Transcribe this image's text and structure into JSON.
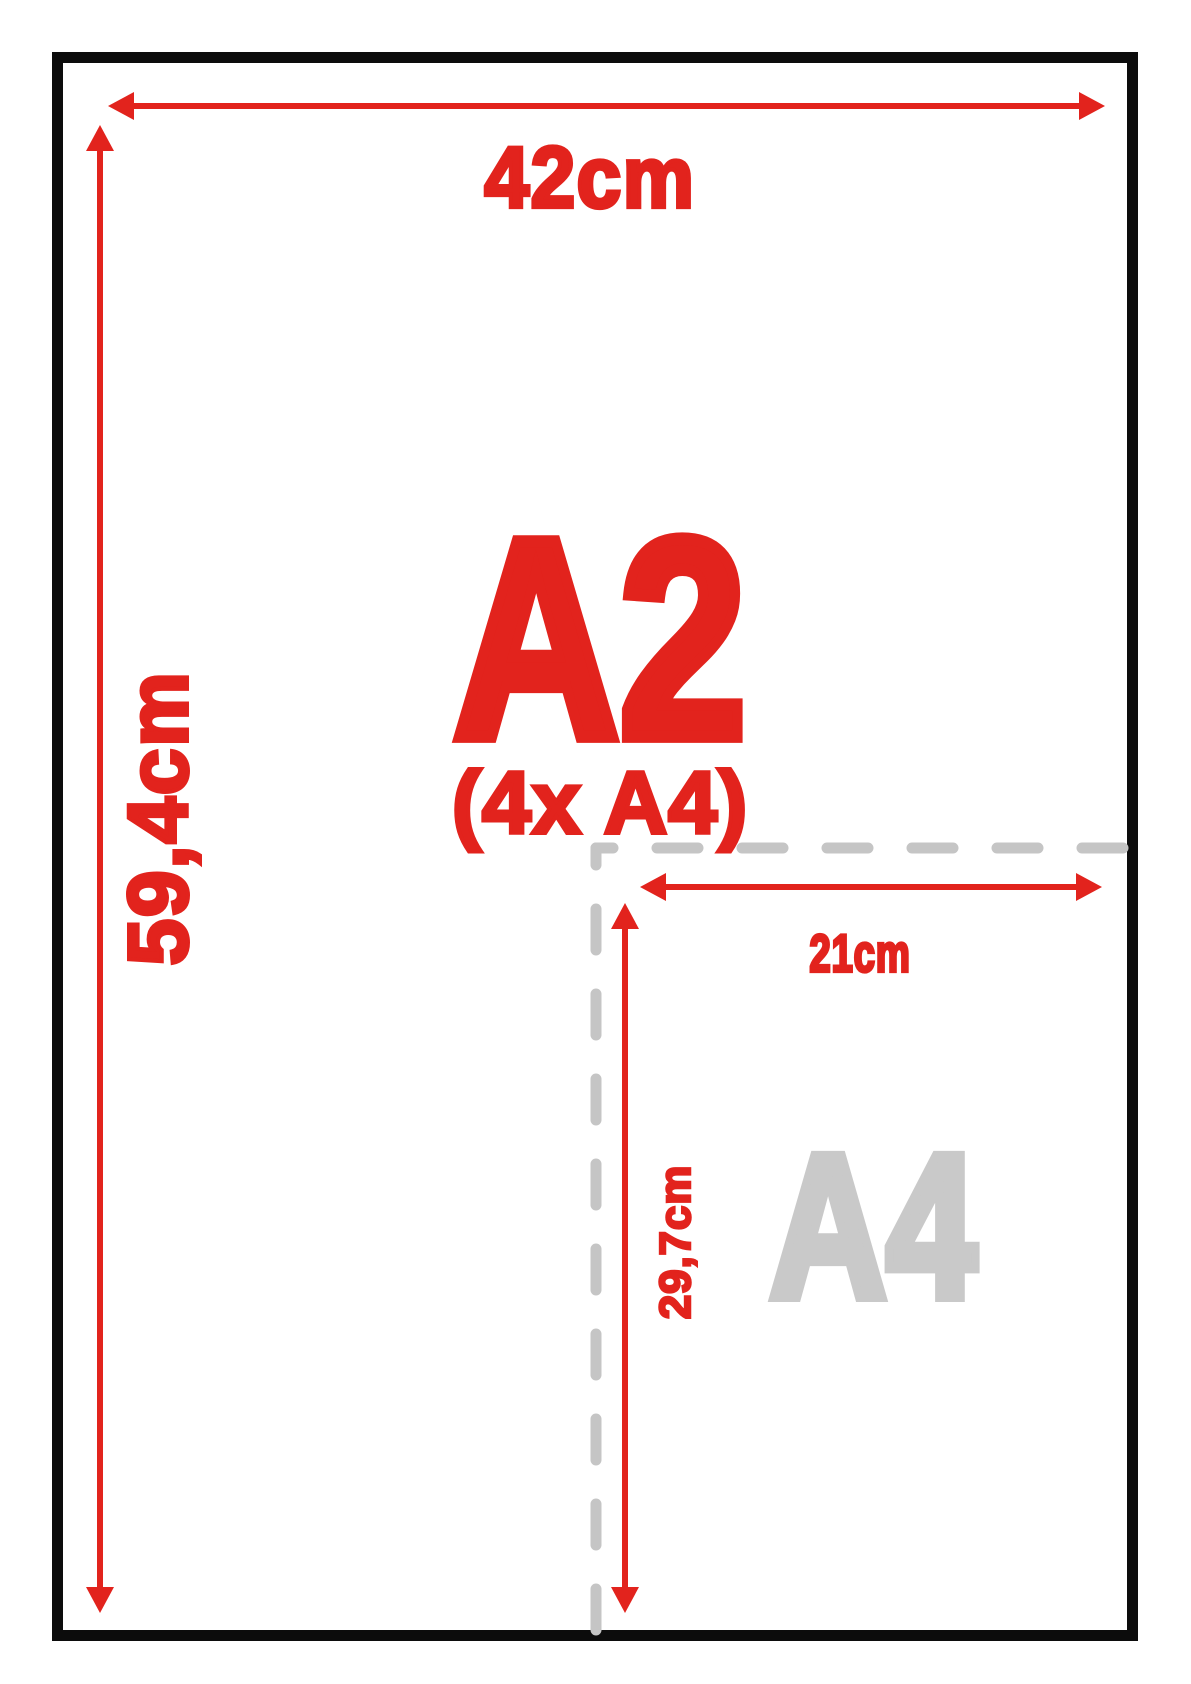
{
  "diagram": {
    "a2_sheet": {
      "name_label": "A2",
      "subtitle_label": "(4x A4)",
      "width_label": "42cm",
      "height_label": "59,4cm"
    },
    "a4_region": {
      "name_label": "A4",
      "width_label": "21cm",
      "height_label": "29,7cm"
    },
    "colors": {
      "accent_red": "#e2231d",
      "sheet_outline_black": "#0c0c0c",
      "dash_gray": "#c5c5c5",
      "a4_label_gray": "#c9c9c9",
      "background": "#ffffff"
    }
  }
}
